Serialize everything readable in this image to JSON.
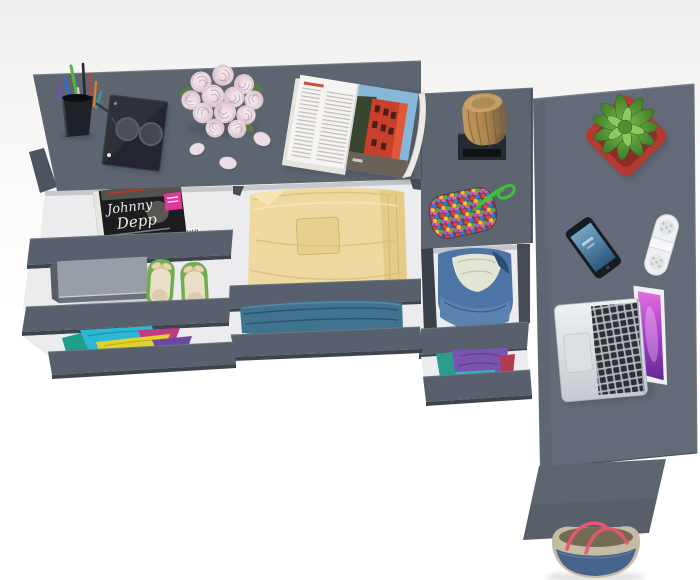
{
  "scene": {
    "type": "furniture-product-render",
    "view": "top-down",
    "description": "Grey L-shaped desk with chest of drawers; drawers pulled open showing clothes and accessories"
  },
  "magazine_cover": {
    "title_line1": "Johnny",
    "title_line2": "Depp"
  },
  "objects": [
    "pen-cup",
    "tablet-with-glasses",
    "rose-bouquet",
    "rose-petals",
    "open-magazine",
    "johnny-depp-magazine",
    "closed-laptop-in-drawer",
    "green-ballet-flats",
    "colorful-clothes",
    "yellow-folded-clothes",
    "blue-jeans",
    "wooden-stool",
    "bead-pouch",
    "denim-jacket",
    "purple-clothes",
    "succulent-in-red-pot",
    "smartphone",
    "white-capsule-speaker",
    "macbook-laptop",
    "tote-bag"
  ],
  "colors": {
    "desk": "#5d6571",
    "desk2": "#626b77",
    "slab": "#57606c",
    "slab_edge": "#3d444e",
    "interior": "#ececee",
    "pot_red": "#b23a31",
    "plant_green": "#5aa83e",
    "clothes_yellow": "#eed9a0",
    "jeans_blue": "#3f7390",
    "denim_blue": "#4e74a6",
    "shoes_green": "#6fae4e",
    "badge_pink": "#e0399b",
    "bag_handle": "#ea5570",
    "screen_purple": "#b43fd0",
    "wood_brown": "#b5905a"
  }
}
